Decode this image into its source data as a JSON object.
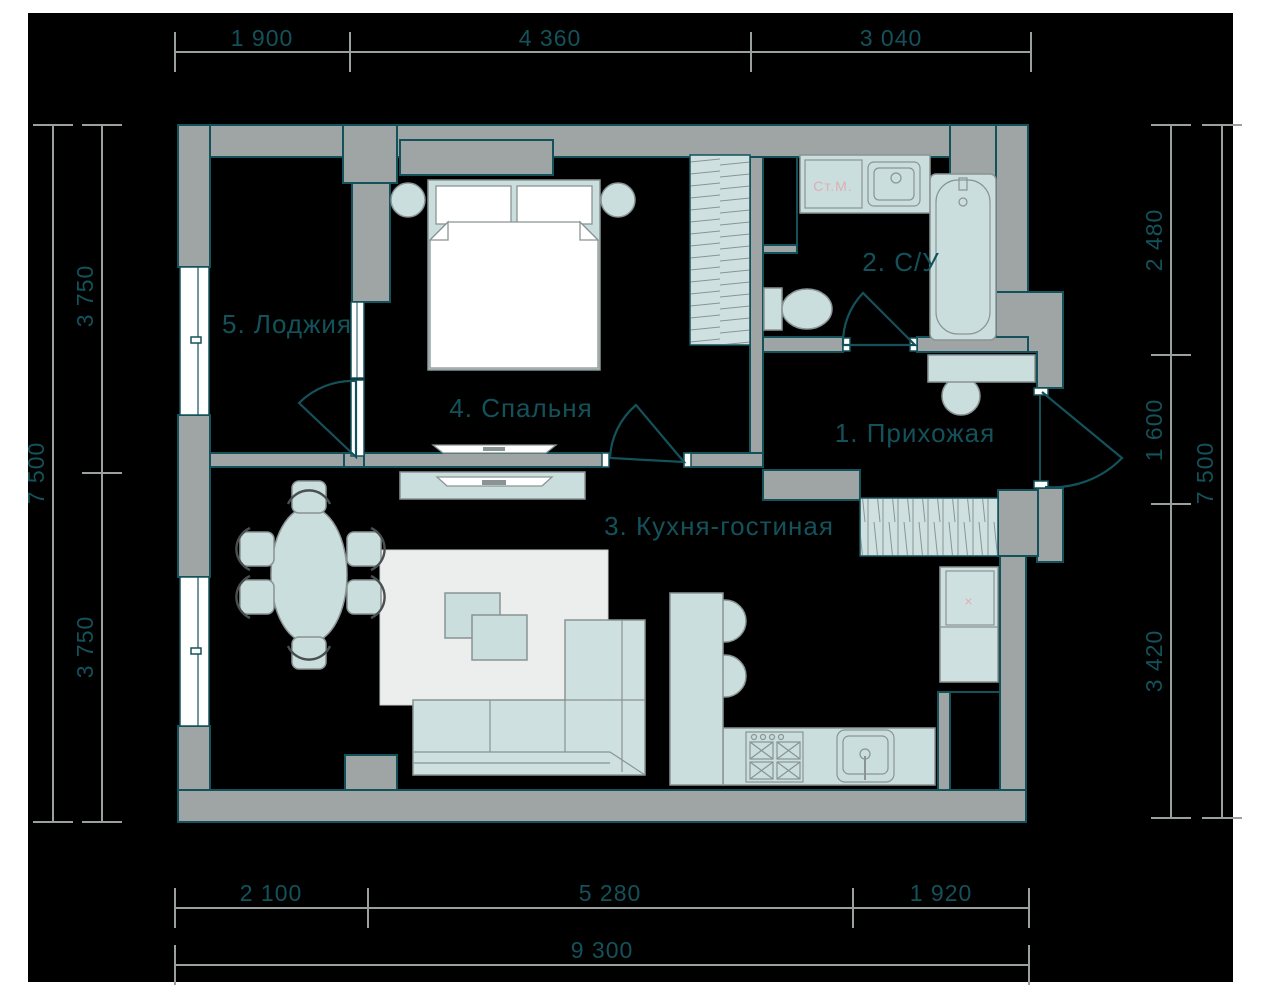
{
  "rooms": [
    {
      "label": "1. Прихожая"
    },
    {
      "label": "2. С/У"
    },
    {
      "label": "3. Кухня-гостиная"
    },
    {
      "label": "4. Спальня"
    },
    {
      "label": "5. Лоджия"
    }
  ],
  "fixtures": {
    "washing_machine": "Ст.М.",
    "fridge_mark": "×"
  },
  "dimensions": {
    "top": [
      "1 900",
      "4 360",
      "3 040"
    ],
    "bottom": [
      "2 100",
      "5 280",
      "1 920"
    ],
    "bottom_total": "9 300",
    "left": [
      "3 750",
      "3 750"
    ],
    "left_total": "7 500",
    "right": [
      "2 480",
      "1 600",
      "3 420"
    ],
    "right_total": "7 500"
  },
  "colors": {
    "background": "#000000",
    "page_margin": "#ffffff",
    "wall": "#9fa5a5",
    "outline_teal": "#14525b",
    "furniture": "#c9dedd",
    "furniture_outline": "#8a9494",
    "rug": "#eceeee",
    "accent_pink": "#dfaeb4",
    "dimension_line": "#9aa0a0"
  }
}
